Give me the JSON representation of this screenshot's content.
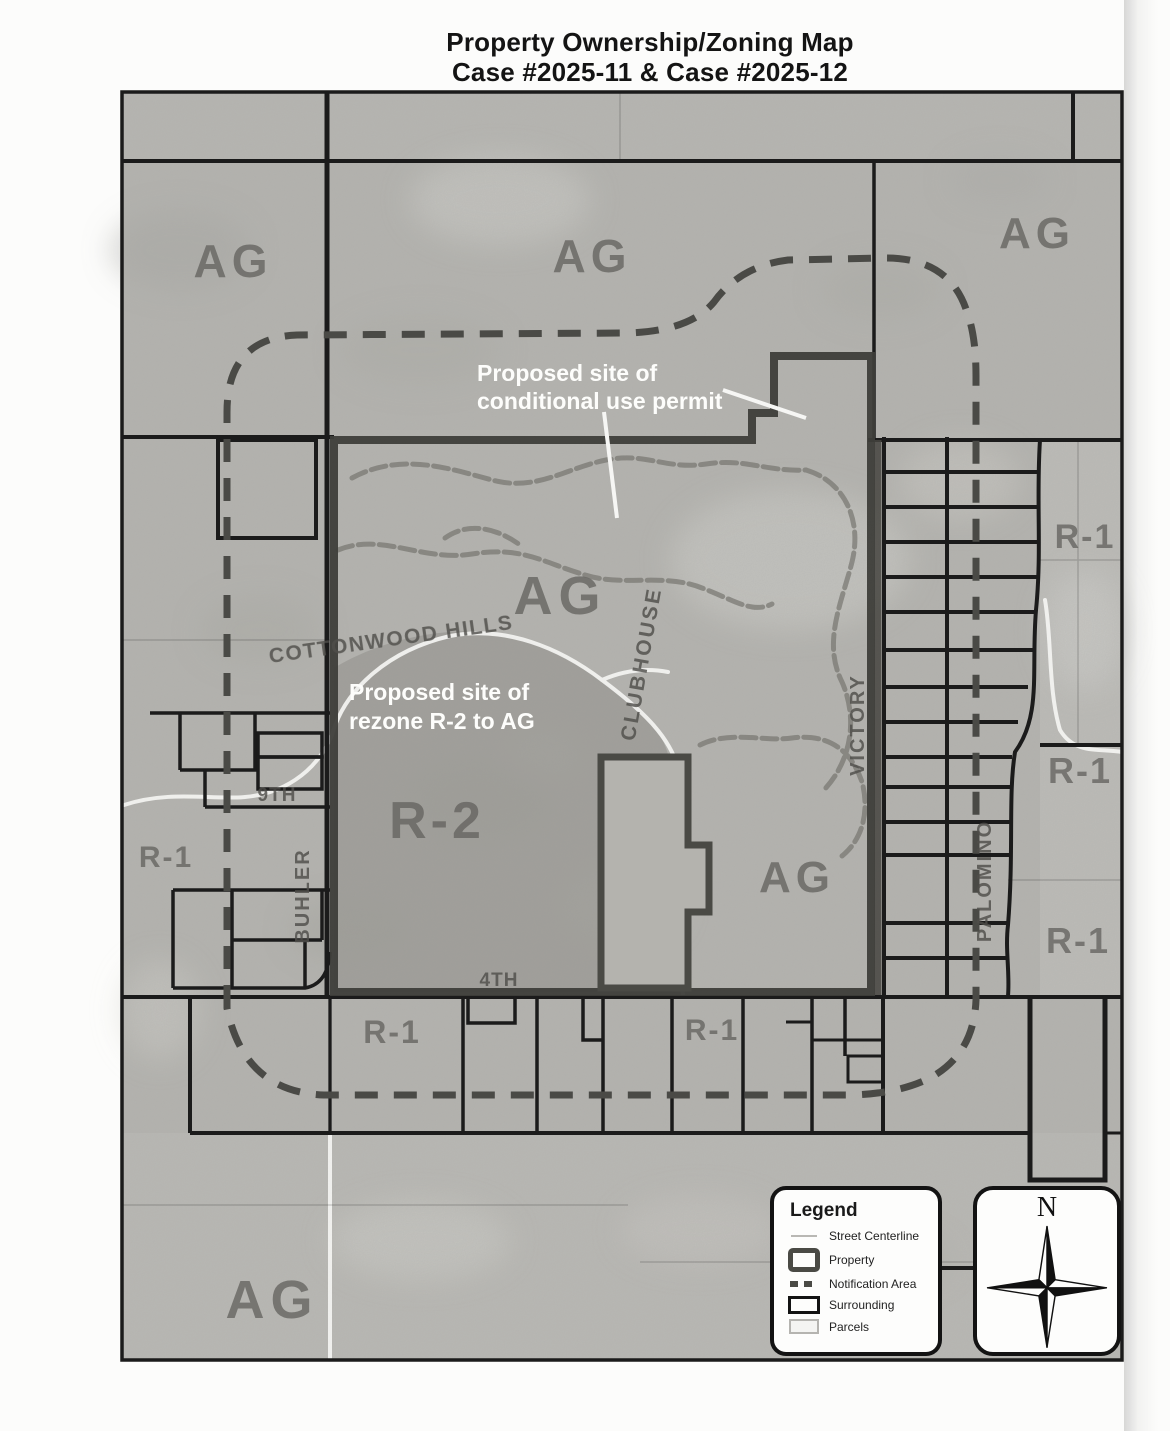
{
  "title": {
    "line1": "Property Ownership/Zoning Map",
    "line2": "Case #2025-11 & Case #2025-12"
  },
  "map": {
    "zones": {
      "ag": "AG",
      "r1": "R-1",
      "r2": "R-2"
    },
    "streets": {
      "cottonwood_hills": "COTTONWOOD HILLS",
      "clubhouse": "CLUBHOUSE",
      "victory": "VICTORY",
      "palomino": "PALOMINO",
      "buhler": "BUHLER",
      "ninth": "9TH",
      "fourth": "4TH"
    },
    "annotations": {
      "conditional_use": {
        "line1": "Proposed site of",
        "line2": "conditional use permit"
      },
      "rezone": {
        "line1": "Proposed site of",
        "line2": "rezone R-2 to AG"
      }
    }
  },
  "legend": {
    "title": "Legend",
    "items": [
      {
        "label": "Street Centerline"
      },
      {
        "label": "Property"
      },
      {
        "label": "Notification Area"
      },
      {
        "label": "Surrounding"
      },
      {
        "label": "Parcels"
      }
    ]
  },
  "compass": {
    "north": "N"
  },
  "colors": {
    "photo_gray": "#b4b3af",
    "r2_shade": "#9c9b96",
    "ink": "#1b1b1b",
    "property_outline": "#3e3e3a",
    "notification_dash": "#4a4a46",
    "zone_label": "#64635f",
    "annotation_white": "#fdfdfb"
  }
}
